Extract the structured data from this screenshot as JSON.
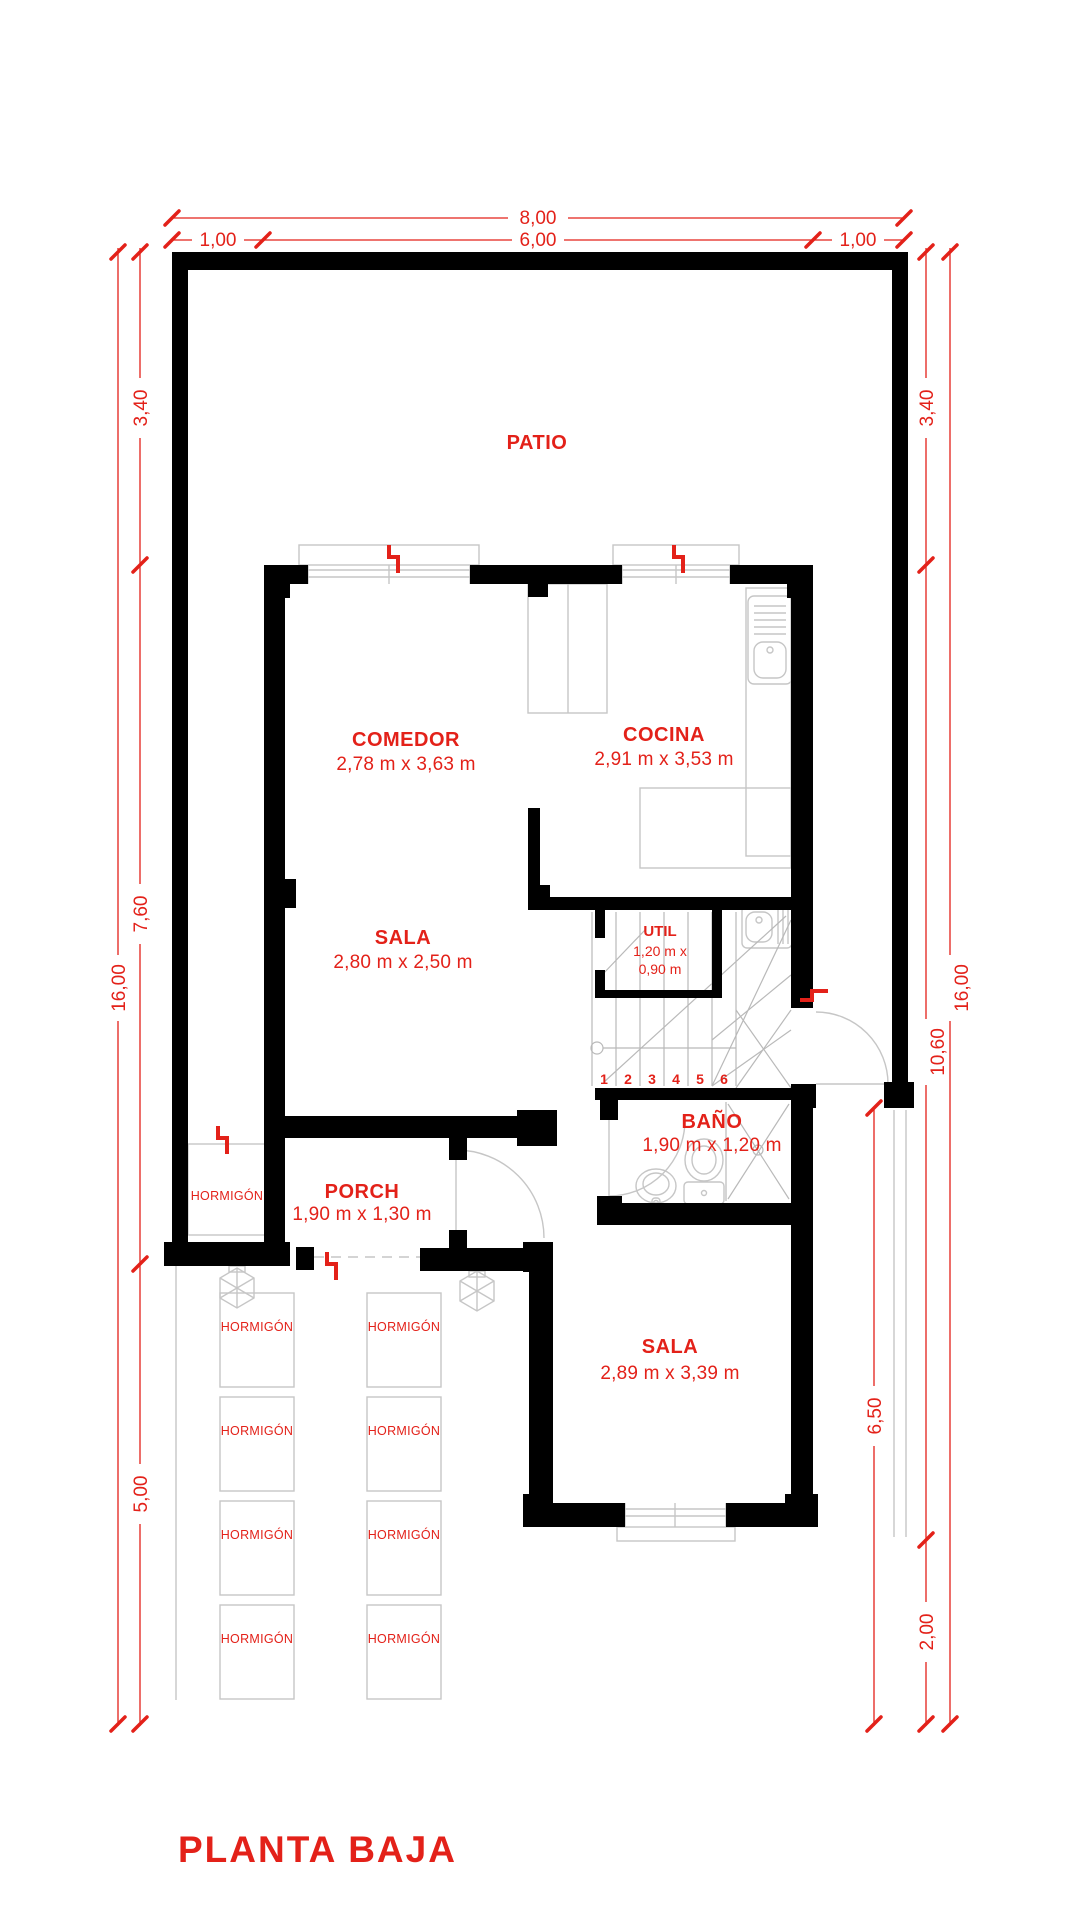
{
  "title": "PLANTA BAJA",
  "colors": {
    "accent_red": "#e32119",
    "wall_black": "#000000",
    "furniture_gray": "#c6c6c6"
  },
  "dims": {
    "total_width": "8,00",
    "side_margin": "1,00",
    "house_width": "6,00",
    "total_height": "16,00",
    "patio_depth": "3,40",
    "house_depth": "7,60",
    "front_yard": "5,00",
    "right_middle": "10,60",
    "right_bottom": "2,00",
    "right_yard": "6,50"
  },
  "rooms": {
    "patio": {
      "name": "PATIO"
    },
    "comedor": {
      "name": "COMEDOR",
      "size": "2,78 m x 3,63 m"
    },
    "cocina": {
      "name": "COCINA",
      "size": "2,91 m x 3,53 m"
    },
    "sala_upper": {
      "name": "SALA",
      "size": "2,80 m x 2,50 m"
    },
    "util": {
      "name": "UTIL",
      "size_line1": "1,20 m x",
      "size_line2": "0,90 m"
    },
    "bano": {
      "name": "BAÑO",
      "size": "1,90 m x 1,20 m"
    },
    "porch": {
      "name": "PORCH",
      "size": "1,90 m x 1,30 m"
    },
    "sala_lower": {
      "name": "SALA",
      "size": "2,89 m x 3,39 m"
    }
  },
  "stairs": {
    "steps": [
      "1",
      "2",
      "3",
      "4",
      "5",
      "6"
    ]
  },
  "materials": {
    "hormigon": "HORMIGÓN"
  }
}
